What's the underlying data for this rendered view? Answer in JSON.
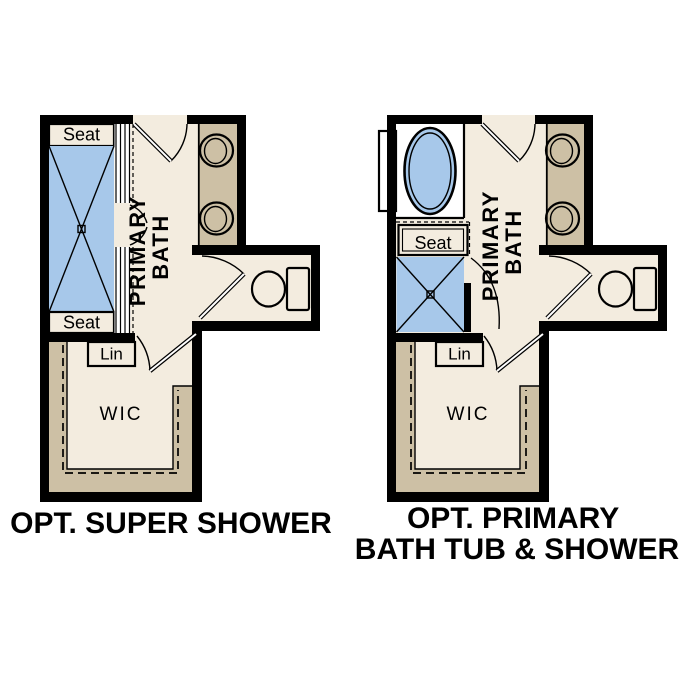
{
  "colors": {
    "background": "#ffffff",
    "wall_black": "#000000",
    "floor_cream": "#f3ecdf",
    "cabinet_tan": "#cdc0a5",
    "fixture_blue": "#a7c8ea",
    "fixture_white": "#ffffff"
  },
  "plans": [
    {
      "id": "opt-super-shower",
      "caption_lines": [
        "OPT. SUPER SHOWER"
      ],
      "room_label_lines": [
        "PRIMARY",
        "BATH"
      ],
      "labels": {
        "seat_top": "Seat",
        "seat_bottom": "Seat",
        "linen": "Lin",
        "closet": "WIC"
      }
    },
    {
      "id": "opt-primary-bath-tub-shower",
      "caption_lines": [
        "OPT. PRIMARY",
        "BATH TUB & SHOWER"
      ],
      "room_label_lines": [
        "PRIMARY",
        "BATH"
      ],
      "labels": {
        "seat": "Seat",
        "linen": "Lin",
        "closet": "WIC"
      }
    }
  ]
}
